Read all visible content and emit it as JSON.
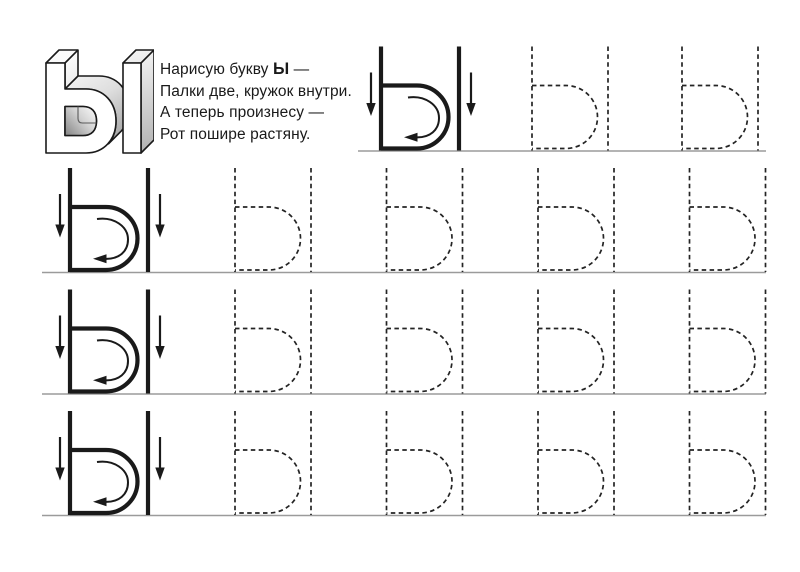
{
  "letter": "Ы",
  "poem": {
    "line1_prefix": "Нарисую букву ",
    "line1_letter": "Ы",
    "line1_suffix": " —",
    "line2": "Палки две, кружок внутри.",
    "line3": "А теперь произнесу —",
    "line4": "Рот пошире растяну."
  },
  "colors": {
    "ink": "#1a1a1a",
    "baseline": "#9b9b9b",
    "shade_dark": "#8e8e8e",
    "shade_mid": "#c4c4c4",
    "shade_light": "#fafafa"
  },
  "rows": [
    {
      "has_example": true,
      "trace_count": 2
    },
    {
      "has_example": true,
      "trace_count": 4
    },
    {
      "has_example": true,
      "trace_count": 4
    },
    {
      "has_example": true,
      "trace_count": 4
    }
  ]
}
